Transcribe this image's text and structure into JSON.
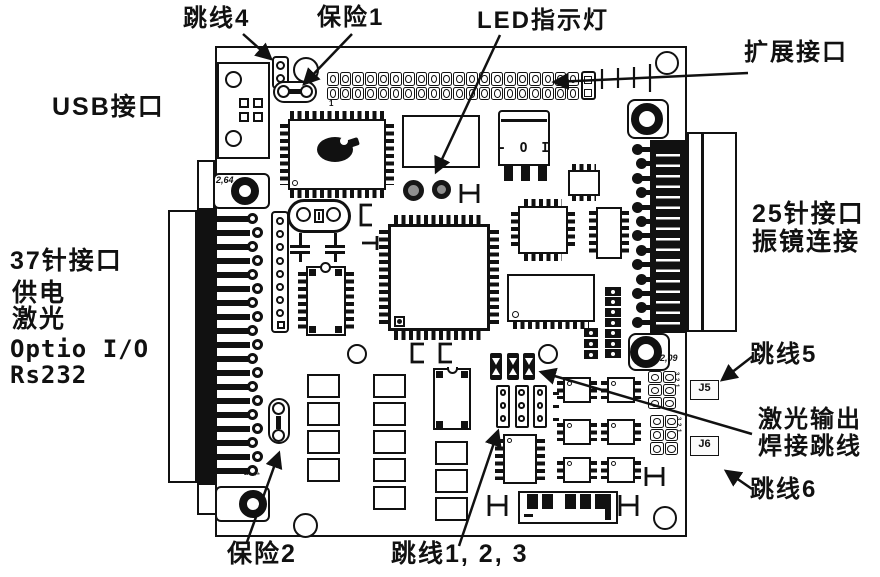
{
  "diagram_type": "pcb-callout-diagram",
  "colors": {
    "ink": "#111111",
    "background": "#ffffff"
  },
  "labels": {
    "jumper4": "跳线4",
    "fuse1": "保险1",
    "led_indicator": "LED指示灯",
    "expansion_port": "扩展接口",
    "usb_port": "USB接口",
    "conn37_lines": [
      "37针接口",
      "供电",
      "激光",
      "Optio I/O",
      "Rs232"
    ],
    "conn25_lines": [
      "25针接口",
      "振镜连接"
    ],
    "jumper5": "跳线5",
    "laser_output_lines": [
      "激光输出",
      "焊接跳线"
    ],
    "jumper6": "跳线6",
    "fuse2": "保险2",
    "jumpers123": "跳线1, 2, 3"
  },
  "board_text": {
    "mount_hole_top_left": "2,64",
    "mount_hole_bottom_right": "2,09",
    "j5_label": "J5",
    "j6_label": "J6",
    "header_pin1": "1",
    "conn37_bottom_pins": [
      "28",
      "1"
    ],
    "regulator_marking": "- O I",
    "j5_row_numbers": [
      "3",
      "2",
      "1"
    ],
    "j6_row_numbers": [
      "3",
      "2",
      "1"
    ]
  },
  "board": {
    "main_header": {
      "rows": 2,
      "cols": 20
    },
    "conn37": {
      "visible_pin_rows": 19
    },
    "conn25": {
      "visible_pin_rows": 13
    },
    "j_headers": {
      "cols": 2,
      "rows": 3
    },
    "jumpers123": {
      "strips": 3,
      "pins_per_strip": 3
    },
    "solder_jumpers": {
      "count": 3
    },
    "soic8_grid": {
      "rows": 3,
      "cols": 2
    },
    "vheader9_pins": 8,
    "vheader6_cells": 7
  }
}
